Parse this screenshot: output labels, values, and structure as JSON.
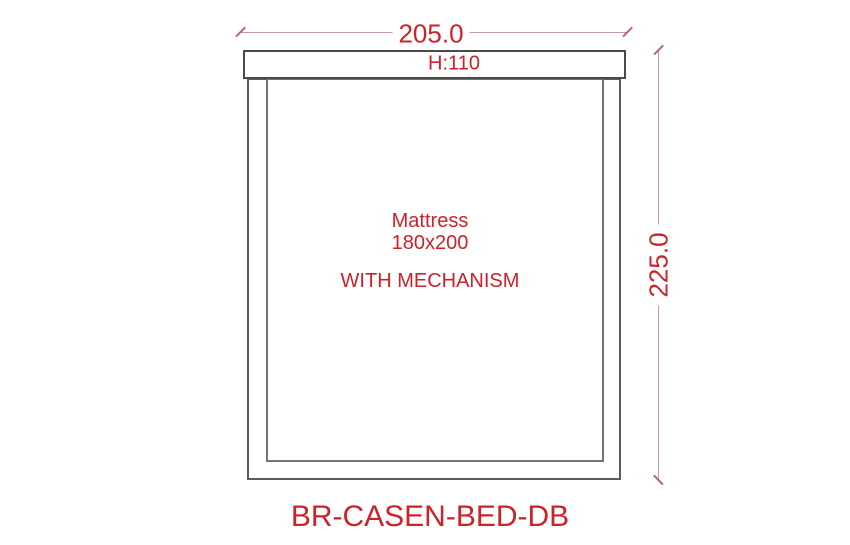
{
  "drawing": {
    "product_code": "BR-CASEN-BED-DB",
    "headboard_label": "H:110",
    "mattress_label": "Mattress",
    "mattress_size": "180x200",
    "mechanism_label": "WITH MECHANISM",
    "width_dimension": "205.0",
    "height_dimension": "225.0"
  },
  "colors": {
    "text-red": "#cc2229",
    "dim-line": "#c59a9d",
    "dim-tick": "#b2686c",
    "frame-dark": "#4a4a4a",
    "frame-mid": "#5c5c5c",
    "frame-light": "#747474",
    "background": "#ffffff"
  }
}
